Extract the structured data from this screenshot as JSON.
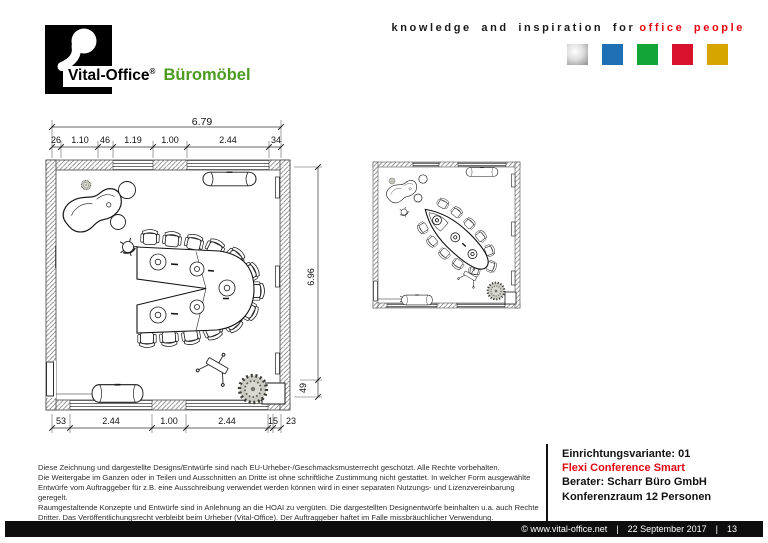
{
  "header": {
    "logo": {
      "brand": "Vital-Office",
      "registered": "®",
      "product": "Büromöbel"
    },
    "tagline": {
      "prefix": "knowledge and inspiration for",
      "highlight": "office people"
    },
    "color_squares": [
      {
        "name": "silver",
        "color": "#c0c0c0"
      },
      {
        "name": "blue",
        "color": "#1f6fb4"
      },
      {
        "name": "green",
        "color": "#13a538"
      },
      {
        "name": "red",
        "color": "#d8112d"
      },
      {
        "name": "gold",
        "color": "#d7a500"
      }
    ]
  },
  "floor_plan": {
    "dim_top_total": "6.79",
    "dim_top_segments": [
      "26",
      "1.10",
      "46",
      "1.19",
      "1.00",
      "2.44",
      "34"
    ],
    "dim_right_total": "6.96",
    "dim_right_segment": "49",
    "dim_bottom_segments": [
      "53",
      "2.44",
      "1.00",
      "2.44",
      "15",
      "23"
    ]
  },
  "info_panel": {
    "variant": "Einrichtungsvariante: 01",
    "product_name": "Flexi Conference Smart",
    "consultant": "Berater: Scharr Büro GmbH",
    "room": "Konferenzraum 12 Personen"
  },
  "disclaimer": {
    "lines": [
      "Diese Zeichnung und dargestellte Designs/Entwürfe sind nach EU-Urheber-/Geschmacksmusterrecht geschützt. Alle Rechte vorbehalten.",
      "Die Weitergabe im Ganzen oder in Teilen und Ausschnitten an Dritte ist ohne schriftliche Zustimmung nicht gestattet. In welcher Form ausgewählte",
      "Entwürfe vom Auftraggeber für z.B. eine Ausschreibung verwendet werden können wird in einer separaten Nutzungs- und Lizenzvereinbarung geregelt.",
      "Raumgestaltende Konzepte und Entwürfe sind in Anlehnung an die HOAI zu vergüten. Die dargestellten Designentwürfe beinhalten u.a. auch Rechte",
      "Dritter. Das Veröffentlichungsrecht verbleibt beim Urheber (Vital-Office). Der Auftraggeber haftet im Falle missbräuchlicher Verwendung."
    ]
  },
  "footer": {
    "copyright": "© www.vital-office.net",
    "separator": "|",
    "date": "22 September 2017",
    "page_number": "13"
  },
  "colors": {
    "brand_green": "#4a9b1e",
    "accent_red": "#e30613"
  }
}
